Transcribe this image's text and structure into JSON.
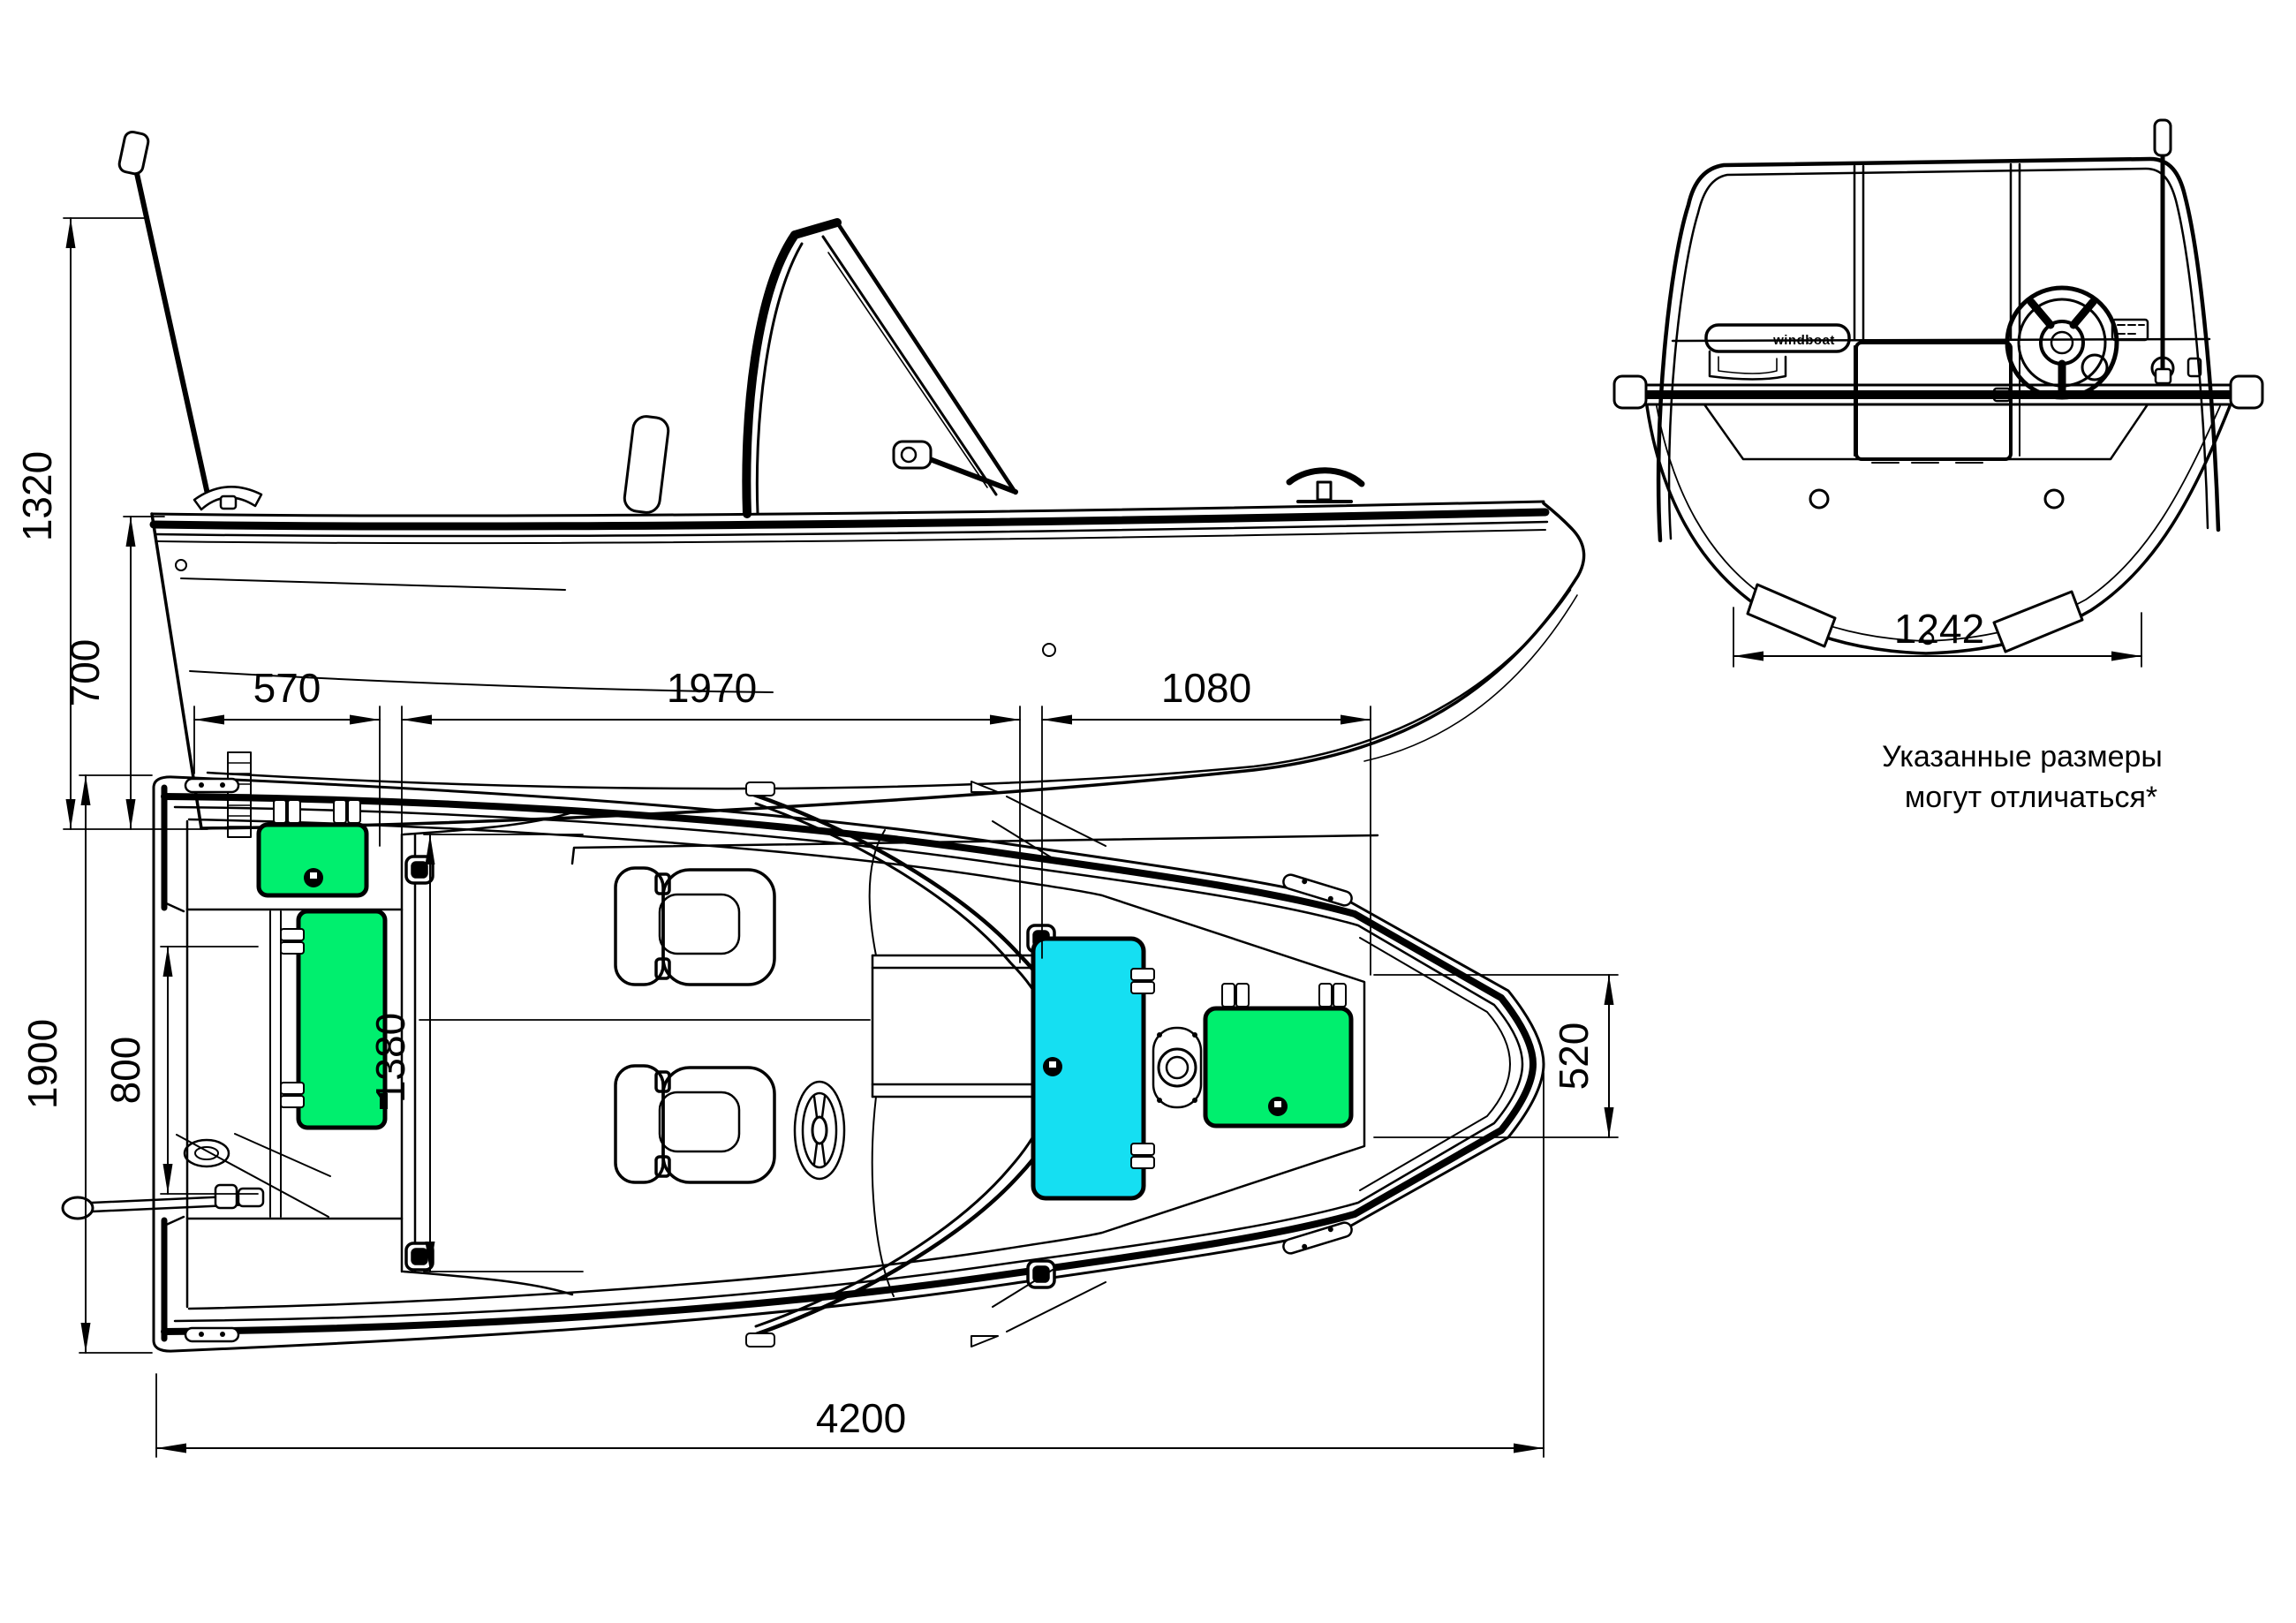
{
  "annotation": {
    "line1": "Указанные размеры",
    "line2": "могут отличаться*"
  },
  "brand_label": "windboat",
  "dimensions": {
    "overall_height": "1320",
    "hull_depth": "700",
    "transom_width": "1242",
    "stern_section": "570",
    "cockpit_length": "1970",
    "bow_section": "1080",
    "beam": "1900",
    "motorwell_width": "800",
    "cockpit_width": "1380",
    "bow_width": "520",
    "overall_length": "4200"
  },
  "colors": {
    "background": "#ffffff",
    "line": "#000000",
    "hatch_green": "#00ef6e",
    "hatch_cyan": "#15dff2"
  }
}
